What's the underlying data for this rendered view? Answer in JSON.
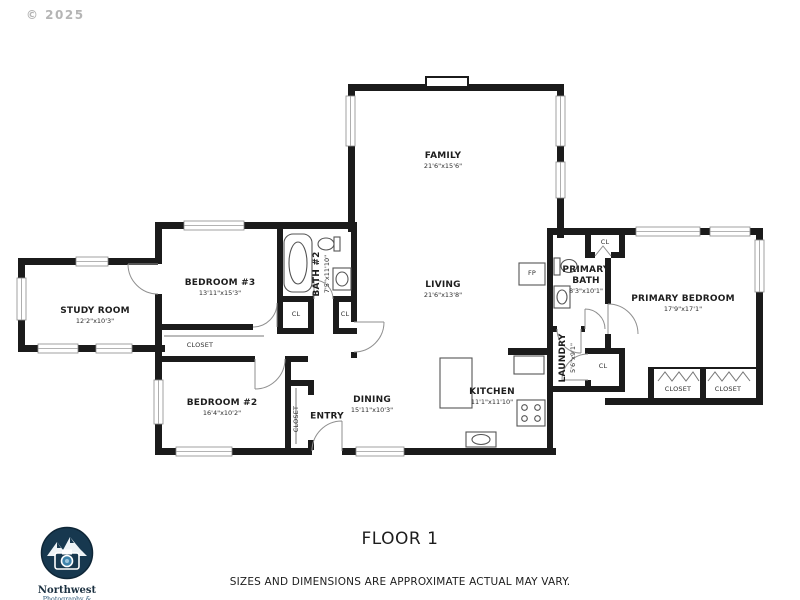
{
  "copyright": "© 2025",
  "floor": {
    "title": "FLOOR 1",
    "disclaimer": "SIZES AND DIMENSIONS ARE APPROXIMATE ACTUAL MAY VARY."
  },
  "logo": {
    "name": "Northwest",
    "tagline": "Photography & Media"
  },
  "rooms": {
    "family": {
      "name": "FAMILY",
      "dims": "21'6\"x15'6\""
    },
    "living": {
      "name": "LIVING",
      "dims": "21'6\"x13'8\""
    },
    "bedroom3": {
      "name": "BEDROOM #3",
      "dims": "13'11\"x15'3\""
    },
    "bath2": {
      "name": "BATH #2",
      "dims": "7'5\"x11'10\""
    },
    "study": {
      "name": "STUDY ROOM",
      "dims": "12'2\"x10'3\""
    },
    "bedroom2": {
      "name": "BEDROOM #2",
      "dims": "16'4\"x10'2\""
    },
    "dining": {
      "name": "DINING",
      "dims": "15'11\"x10'3\""
    },
    "entry": {
      "name": "ENTRY"
    },
    "kitchen": {
      "name": "KITCHEN",
      "dims": "11'1\"x11'10\""
    },
    "laundry": {
      "name": "LAUNDRY",
      "dims": "5'6\"x9'1\""
    },
    "primary_bath": {
      "name": "PRIMARY BATH",
      "dims": "8'3\"x10'1\""
    },
    "primary_bedroom": {
      "name": "PRIMARY BEDROOM",
      "dims": "17'9\"x17'1\""
    }
  },
  "closets": {
    "hall": "CLOSET",
    "entry": "CLOSET",
    "primary_1": "CLOSET",
    "primary_2": "CLOSET",
    "cl": "CL"
  },
  "labels": {
    "fireplace": "FP"
  }
}
